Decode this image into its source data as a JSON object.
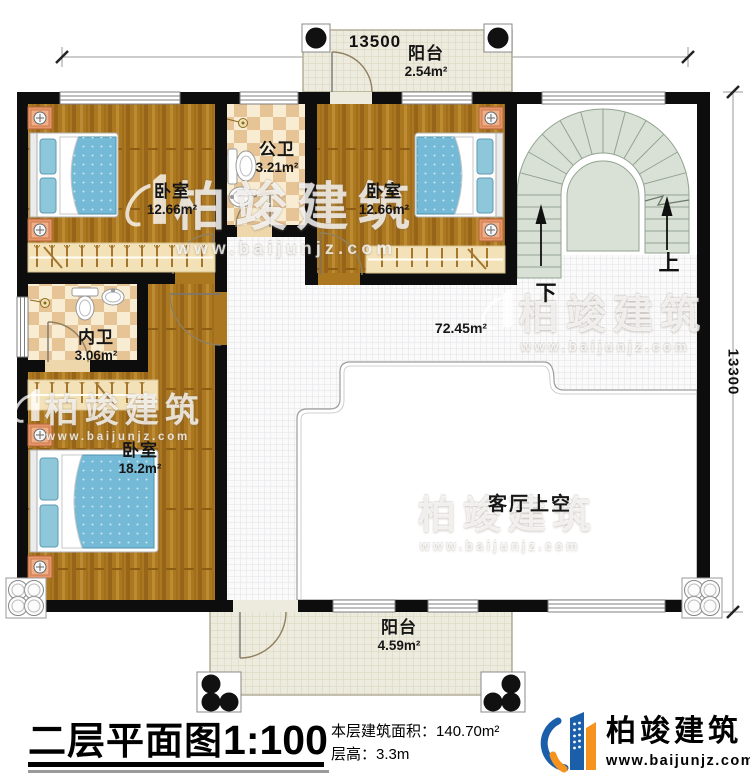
{
  "dimensions": {
    "top": "13500",
    "right": "13300"
  },
  "rooms": {
    "balcony_top": {
      "name": "阳台",
      "area": "2.54m²"
    },
    "bedroom1": {
      "name": "卧室",
      "area": "12.66m²"
    },
    "public_bath": {
      "name": "公卫",
      "area": "3.21m²"
    },
    "bedroom2": {
      "name": "卧室",
      "area": "12.66m²"
    },
    "inner_bath": {
      "name": "内卫",
      "area": "3.06m²"
    },
    "bedroom3": {
      "name": "卧室",
      "area": "18.2m²"
    },
    "hall": {
      "area": "72.45m²"
    },
    "living_void": {
      "name": "客厅上空"
    },
    "balcony_bottom": {
      "name": "阳台",
      "area": "4.59m²"
    }
  },
  "stairs": {
    "up_label": "上",
    "down_label": "下"
  },
  "title_block": {
    "plan_title": "二层平面图",
    "scale": "1:100",
    "area_label": "本层建筑面积：",
    "area_value": "140.70m²",
    "floor_height_label": "层高：",
    "floor_height_value": "3.3m"
  },
  "brand": {
    "name": "柏竣建筑",
    "website": "www.baijunjz.com"
  },
  "watermark": {
    "name": "柏竣建筑",
    "website": "www.baijunjz.com"
  },
  "colors": {
    "wall": "#0d0d0d",
    "wood_floor": "#ab7820",
    "tile_dark": "#e6c496",
    "tile_light": "#f8edd3",
    "balcony_floor": "#edeade",
    "stair_fill": "#d9e1d6",
    "mattress_blue": "#74b9d6",
    "nightstand_orange": "#e8956a",
    "brand_blue": "#1b5ea9",
    "brand_orange": "#f6921e"
  }
}
